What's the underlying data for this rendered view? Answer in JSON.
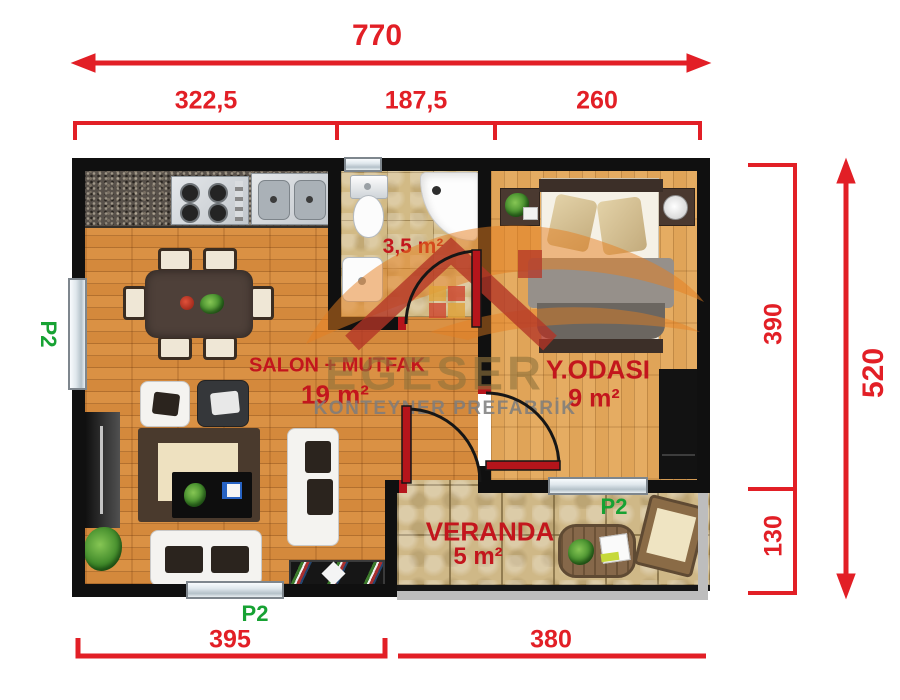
{
  "watermark": {
    "name": "EGESER",
    "tagline": "KONTEYNER PREFABRİK"
  },
  "dimensions": {
    "top_total": "770",
    "top_segments": [
      {
        "label": "322,5"
      },
      {
        "label": "187,5"
      },
      {
        "label": "260"
      }
    ],
    "right_segments": [
      {
        "label": "390"
      },
      {
        "label": "130"
      }
    ],
    "right_total": "520",
    "bottom_segments": [
      {
        "label": "395"
      },
      {
        "label": "380"
      }
    ]
  },
  "rooms": {
    "salon": {
      "name": "SALON + MUTFAK",
      "area": "19 m²"
    },
    "bathroom": {
      "area": "3,5 m²"
    },
    "bedroom": {
      "name": "Y.ODASI",
      "area": "9 m²"
    },
    "veranda": {
      "name": "VERANDA",
      "area": "5 m²"
    }
  },
  "openings": {
    "left_window": {
      "label": "P2"
    },
    "bottom_window": {
      "label": "P2"
    },
    "veranda_window": {
      "label": "P2"
    }
  },
  "colors": {
    "dimension_red": "#e21f26",
    "room_label_red": "#c3161d",
    "opening_green": "#17a233",
    "wall_black": "#101010",
    "salon_floor": "#d4893c",
    "bedroom_floor": "#e0a458",
    "tile_beige": "#d2ba85"
  }
}
